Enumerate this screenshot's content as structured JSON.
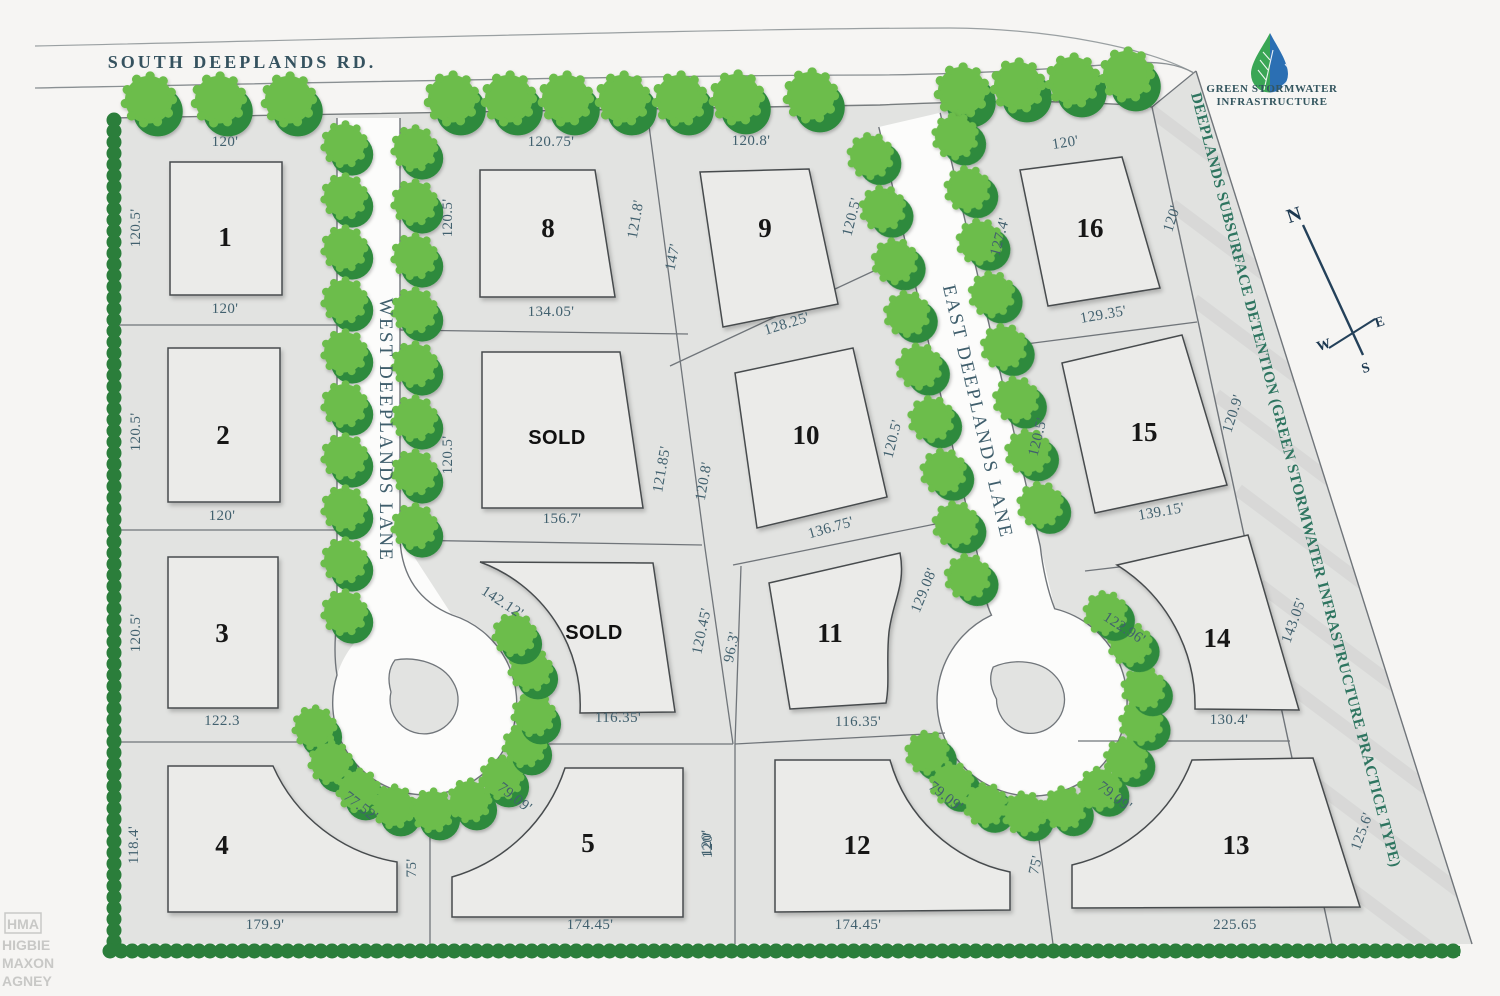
{
  "road": {
    "name": "SOUTH DEEPLANDS RD."
  },
  "lanes": {
    "west": "WEST DEEPLANDS LANE",
    "east": "EAST DEEPLANDS LANE"
  },
  "detention_strip": {
    "label": "DEEPLANDS SUBSURFACE DETENTION (GREEN STORMWATER INFRASTRUCTURE PRACTICE TYPE)"
  },
  "logo": {
    "icon": "green-stormwater-droplet-icon",
    "line1": "GREEN STORMWATER",
    "line2": "INFRASTRUCTURE"
  },
  "compass": {
    "north": "N",
    "east": "E",
    "south": "S",
    "west": "W"
  },
  "watermark": {
    "monogram": "HMA",
    "lines": [
      "HIGBIE",
      "MAXON",
      "AGNEY"
    ]
  },
  "colors": {
    "lot_fill": "#e2e3e1",
    "building_fill": "#ebebe9",
    "boundary": "#70757a",
    "tree_light": "#6cbd4c",
    "tree_dark": "#2f8a3e",
    "hedge": "#2b7e3b",
    "label_slate": "#41606e",
    "strip_text_green": "#2e7560",
    "logo_green": "#3aa655",
    "logo_blue": "#2b6fb3",
    "paper": "#f6f5f3"
  },
  "lots": [
    {
      "id": "1",
      "label": "1",
      "dims": {
        "top": "120'",
        "left": "120.5'",
        "bottom": "120'"
      }
    },
    {
      "id": "2",
      "label": "2",
      "dims": {
        "left": "120.5'",
        "bottom": "120'"
      }
    },
    {
      "id": "3",
      "label": "3",
      "dims": {
        "left": "120.5'",
        "bottom": "122.3"
      }
    },
    {
      "id": "4",
      "label": "4",
      "dims": {
        "left": "118.4'",
        "cul": "77.52'",
        "bottom": "179.9'",
        "side": "75'"
      }
    },
    {
      "id": "5",
      "label": "5",
      "dims": {
        "cul": "79.09'",
        "bottom": "174.45'",
        "right": "120'"
      }
    },
    {
      "id": "6",
      "label": "SOLD",
      "dims": {
        "front": "142.12'",
        "right": "120.45'",
        "bottom": "116.35'"
      }
    },
    {
      "id": "7",
      "label": "SOLD",
      "dims": {
        "left": "120.5'",
        "right": "121.85'",
        "bottom": "156.7'"
      }
    },
    {
      "id": "8",
      "label": "8",
      "dims": {
        "top": "120.75'",
        "left": "120.5'",
        "right": "121.8'",
        "bottom": "134.05'"
      }
    },
    {
      "id": "9",
      "label": "9",
      "dims": {
        "top": "120.8'",
        "left": "147'",
        "right": "120.5'",
        "bottom": "128.25'"
      }
    },
    {
      "id": "10",
      "label": "10",
      "dims": {
        "left": "120.8'",
        "right": "120.5'",
        "bottom": "136.75'"
      }
    },
    {
      "id": "11",
      "label": "11",
      "dims": {
        "left": "96.3'",
        "right": "129.08'",
        "bottom": "116.35'"
      }
    },
    {
      "id": "12",
      "label": "12",
      "dims": {
        "left": "120'",
        "cul": "79.09'",
        "bottom": "174.45'",
        "side": "75'"
      }
    },
    {
      "id": "13",
      "label": "13",
      "dims": {
        "cul": "79.09'",
        "right": "125.6'",
        "bottom": "225.65"
      }
    },
    {
      "id": "14",
      "label": "14",
      "dims": {
        "front": "122.96'",
        "right": "143.05'",
        "bottom": "130.4'"
      }
    },
    {
      "id": "15",
      "label": "15",
      "dims": {
        "left": "120.5'",
        "right": "120.9'",
        "bottom": "139.15'"
      }
    },
    {
      "id": "16",
      "label": "16",
      "dims": {
        "top": "120'",
        "left": "127.4'",
        "right": "120'",
        "bottom": "129.35'"
      }
    }
  ]
}
